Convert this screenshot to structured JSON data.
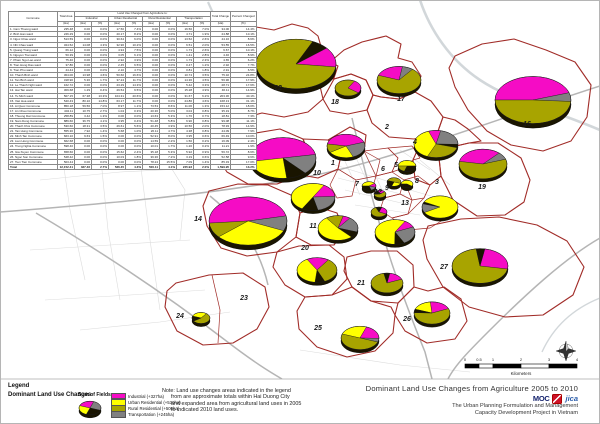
{
  "table": {
    "span_title": "Land Use Changed from Agriculture to:",
    "col_commune": "Commune",
    "col_total_area": "Total Area",
    "unit_ha": "(Ha)",
    "unit_pct": "(%)",
    "groups": [
      "Industrial",
      "Urban Residential",
      "Rural Residential",
      "Transportation"
    ],
    "col_total_change": "Total Change",
    "col_pct_change": "Percent Changed",
    "rows": [
      [
        "1. Cam Thuong ward",
        "235.48",
        "0.00",
        "0.0%",
        "17.50",
        "7.4%",
        "0.00",
        "0.0%",
        "16.50",
        "7.0%",
        "34.00",
        "14.4%"
      ],
      [
        "2. Binh Han ward",
        "246.29",
        "0.00",
        "0.0%",
        "20.17",
        "8.2%",
        "0.00",
        "0.0%",
        "4.71",
        "1.9%",
        "24.88",
        "10.1%"
      ],
      [
        "3. Ngoc Chau ward",
        "513.59",
        "0.00",
        "0.0%",
        "30.64",
        "6.0%",
        "0.00",
        "0.0%",
        "13.52",
        "2.6%",
        "44.16",
        "8.6%"
      ],
      [
        "4. Nhi Chau ward",
        "324.52",
        "14.08",
        "4.3%",
        "32.96",
        "10.2%",
        "0.00",
        "0.0%",
        "6.51",
        "2.0%",
        "53.55",
        "16.5%"
      ],
      [
        "5. Quang Trung ward",
        "66.12",
        "0.00",
        "0.0%",
        "4.94",
        "7.5%",
        "0.00",
        "0.0%",
        "1.73",
        "2.6%",
        "6.67",
        "10.1%"
      ],
      [
        "6. Nguyen Trai ward",
        "50.39",
        "0.00",
        "0.0%",
        "3.05",
        "6.1%",
        "0.00",
        "0.0%",
        "1.41",
        "2.8%",
        "4.46",
        "8.9%"
      ],
      [
        "7. Pham Ngu Lao ward",
        "75.40",
        "0.00",
        "0.0%",
        "2.92",
        "3.9%",
        "0.00",
        "0.0%",
        "1.73",
        "2.3%",
        "4.65",
        "6.2%"
      ],
      [
        "8. Tran Hung Dao ward",
        "37.86",
        "0.00",
        "0.0%",
        "2.45",
        "6.5%",
        "0.00",
        "0.0%",
        "0.47",
        "1.2%",
        "2.92",
        "7.7%"
      ],
      [
        "9. Tran Phu ward",
        "44.44",
        "0.00",
        "0.0%",
        "2.10",
        "4.7%",
        "0.00",
        "0.0%",
        "0.81",
        "1.8%",
        "2.91",
        "6.5%"
      ],
      [
        "10. Thanh Binh ward",
        "304.00",
        "13.98",
        "4.6%",
        "50.60",
        "16.6%",
        "0.00",
        "0.0%",
        "10.74",
        "3.5%",
        "75.32",
        "24.8%"
      ],
      [
        "11. Tan Binh ward",
        "318.90",
        "5.36",
        "1.7%",
        "37.24",
        "11.7%",
        "0.00",
        "0.0%",
        "14.36",
        "4.5%",
        "56.96",
        "17.9%"
      ],
      [
        "12. Le Thanh Nghi ward",
        "162.72",
        "0.00",
        "0.0%",
        "23.29",
        "14.3%",
        "0.00",
        "0.0%",
        "5.42",
        "3.3%",
        "28.71",
        "17.6%"
      ],
      [
        "13. Hai Tan ward",
        "309.68",
        "1.29",
        "0.4%",
        "29.54",
        "9.5%",
        "0.00",
        "0.0%",
        "15.28",
        "4.9%",
        "46.11",
        "14.9%"
      ],
      [
        "14. Tu Minh ward",
        "507.15",
        "67.38",
        "13.3%",
        "104.31",
        "20.6%",
        "0.00",
        "0.0%",
        "31.67",
        "6.2%",
        "203.36",
        "40.1%"
      ],
      [
        "15. Viet Hoa ward",
        "540.43",
        "80.10",
        "14.8%",
        "63.17",
        "11.7%",
        "0.00",
        "0.0%",
        "24.86",
        "4.6%",
        "168.13",
        "31.1%"
      ],
      [
        "16. Ai Quoc Commune",
        "850.18",
        "59.56",
        "7.0%",
        "8.97",
        "1.1%",
        "73.53",
        "8.6%",
        "11.06",
        "1.3%",
        "153.12",
        "18.0%"
      ],
      [
        "17. An Chau Commune",
        "404.11",
        "10.75",
        "2.7%",
        "1.04",
        "0.3%",
        "20.36",
        "5.0%",
        "3.04",
        "0.8%",
        "35.19",
        "8.7%"
      ],
      [
        "18. Thuong Dat Commune",
        "258.89",
        "3.42",
        "1.3%",
        "0.00",
        "0.0%",
        "13.63",
        "5.3%",
        "1.76",
        "0.7%",
        "18.81",
        "7.3%"
      ],
      [
        "19. Nam Dong Commune",
        "889.60",
        "36.75",
        "4.1%",
        "3.95",
        "0.4%",
        "51.48",
        "5.8%",
        "6.90",
        "0.8%",
        "99.08",
        "11.1%"
      ],
      [
        "20. Thach Khoi Commune",
        "530.60",
        "18.31",
        "3.5%",
        "29.61",
        "5.6%",
        "20.45",
        "3.9%",
        "10.56",
        "2.0%",
        "78.93",
        "14.9%"
      ],
      [
        "21. Tan Hung Commune",
        "555.30",
        "7.92",
        "1.4%",
        "5.68",
        "1.0%",
        "26.11",
        "4.7%",
        "4.38",
        "0.8%",
        "44.09",
        "7.9%"
      ],
      [
        "22. Minh Tan Commune",
        "663.10",
        "9.63",
        "1.5%",
        "0.00",
        "0.0%",
        "52.91",
        "8.0%",
        "3.95",
        "0.6%",
        "66.49",
        "10.0%"
      ],
      [
        "23. Lien Hong Commune",
        "662.68",
        "0.00",
        "0.0%",
        "0.00",
        "0.0%",
        "14.59",
        "2.2%",
        "1.50",
        "0.2%",
        "16.09",
        "2.4%"
      ],
      [
        "24. Trung Nghia Commune",
        "598.40",
        "0.00",
        "0.0%",
        "0.00",
        "0.0%",
        "10.01",
        "1.7%",
        "1.20",
        "0.2%",
        "11.21",
        "1.9%"
      ],
      [
        "25. Gia Xuyen Commune",
        "658.60",
        "0.00",
        "0.0%",
        "15.62",
        "2.4%",
        "35.18",
        "5.3%",
        "5.92",
        "0.9%",
        "56.72",
        "8.6%"
      ],
      [
        "26. Ngoc Son Commune",
        "548.42",
        "0.00",
        "0.0%",
        "10.03",
        "1.8%",
        "39.36",
        "7.2%",
        "3.19",
        "0.6%",
        "52.58",
        "9.6%"
      ],
      [
        "27. Tien Tien Commune",
        "503.44",
        "0.00",
        "0.0%",
        "0.00",
        "0.0%",
        "78.24",
        "15.5%",
        "7.09",
        "1.4%",
        "85.33",
        "17.0%"
      ]
    ],
    "total_row": [
      "Total",
      "12,152.41",
      "327.46",
      "2.7%",
      "526.45",
      "4.3%",
      "500.11",
      "4.1%",
      "245.93",
      "2.0%",
      "1,599.95",
      "13.2%"
    ]
  },
  "map": {
    "colors": {
      "industrial": "#F50CC5",
      "urban_residential": "#FFFF00",
      "rural_residential": "#A8A400",
      "transportation": "#808080",
      "pie_base": "#1A1500",
      "boundary": "#A12C28",
      "road_major": "#B5B5B5",
      "road_minor": "#DCDCDC"
    },
    "district_labels": [
      {
        "n": "1",
        "x": 333,
        "y": 165
      },
      {
        "n": "2",
        "x": 387,
        "y": 129
      },
      {
        "n": "3",
        "x": 437,
        "y": 184
      },
      {
        "n": "4",
        "x": 415,
        "y": 144
      },
      {
        "n": "5",
        "x": 396,
        "y": 167
      },
      {
        "n": "6",
        "x": 383,
        "y": 171
      },
      {
        "n": "7",
        "x": 357,
        "y": 186
      },
      {
        "n": "8",
        "x": 417,
        "y": 183
      },
      {
        "n": "9",
        "x": 387,
        "y": 190
      },
      {
        "n": "10",
        "x": 317,
        "y": 175
      },
      {
        "n": "11",
        "x": 313,
        "y": 228
      },
      {
        "n": "12",
        "x": 378,
        "y": 194
      },
      {
        "n": "13",
        "x": 405,
        "y": 205
      },
      {
        "n": "14",
        "x": 198,
        "y": 221
      },
      {
        "n": "15",
        "x": 244,
        "y": 155
      },
      {
        "n": "16",
        "x": 527,
        "y": 126
      },
      {
        "n": "17",
        "x": 401,
        "y": 101
      },
      {
        "n": "18",
        "x": 335,
        "y": 104
      },
      {
        "n": "19",
        "x": 482,
        "y": 189
      },
      {
        "n": "20",
        "x": 305,
        "y": 250
      },
      {
        "n": "21",
        "x": 361,
        "y": 285
      },
      {
        "n": "22",
        "x": 278,
        "y": 90
      },
      {
        "n": "23",
        "x": 244,
        "y": 300
      },
      {
        "n": "24",
        "x": 180,
        "y": 318
      },
      {
        "n": "25",
        "x": 318,
        "y": 330
      },
      {
        "n": "26",
        "x": 407,
        "y": 321
      },
      {
        "n": "27",
        "x": 444,
        "y": 269
      }
    ],
    "pies": [
      {
        "district": "22",
        "cx": 296,
        "cy": 64,
        "r": 40,
        "start": 320,
        "slices": [
          [
            "M",
            0.13
          ],
          [
            "O",
            0.8
          ],
          [
            "K",
            0.07
          ]
        ]
      },
      {
        "district": "18",
        "cx": 348,
        "cy": 88,
        "r": 13,
        "start": 300,
        "slices": [
          [
            "M",
            0.27
          ],
          [
            "O",
            0.73
          ]
        ]
      },
      {
        "district": "17",
        "cx": 399,
        "cy": 80,
        "r": 22,
        "start": 200,
        "slices": [
          [
            "M",
            0.22
          ],
          [
            "G",
            0.08
          ],
          [
            "O",
            0.7
          ]
        ]
      },
      {
        "district": "16",
        "cx": 533,
        "cy": 100,
        "r": 38,
        "start": 180,
        "slices": [
          [
            "M",
            0.45
          ],
          [
            "G",
            0.06
          ],
          [
            "O",
            0.49
          ]
        ]
      },
      {
        "district": "1",
        "cx": 346,
        "cy": 146,
        "r": 19,
        "start": 190,
        "slices": [
          [
            "M",
            0.42
          ],
          [
            "G",
            0.24
          ],
          [
            "Y",
            0.22
          ],
          [
            "O",
            0.12
          ]
        ]
      },
      {
        "district": "4",
        "cx": 436,
        "cy": 144,
        "r": 22,
        "start": 250,
        "slices": [
          [
            "M",
            0.09
          ],
          [
            "G",
            0.22
          ],
          [
            "K",
            0.04
          ],
          [
            "O",
            0.27
          ],
          [
            "Y",
            0.38
          ]
        ]
      },
      {
        "district": "15",
        "cx": 283,
        "cy": 158,
        "r": 33,
        "start": 170,
        "slices": [
          [
            "M",
            0.5
          ],
          [
            "G",
            0.16
          ],
          [
            "K",
            0.1
          ],
          [
            "Y",
            0.24
          ]
        ]
      },
      {
        "district": "5",
        "cx": 407,
        "cy": 166,
        "r": 9,
        "start": 180,
        "slices": [
          [
            "Y",
            0.5
          ],
          [
            "K",
            0.3
          ],
          [
            "O",
            0.2
          ]
        ]
      },
      {
        "district": "7",
        "cx": 369,
        "cy": 186,
        "r": 7,
        "start": 180,
        "slices": [
          [
            "Y",
            0.4
          ],
          [
            "M",
            0.15
          ],
          [
            "G",
            0.15
          ],
          [
            "K",
            0.3
          ]
        ]
      },
      {
        "district": "9",
        "cx": 394,
        "cy": 182,
        "r": 7,
        "start": 200,
        "slices": [
          [
            "O",
            0.5
          ],
          [
            "Y",
            0.25
          ],
          [
            "K",
            0.25
          ]
        ]
      },
      {
        "district": "8",
        "cx": 407,
        "cy": 184,
        "r": 6,
        "start": 180,
        "slices": [
          [
            "Y",
            0.6
          ],
          [
            "K",
            0.4
          ]
        ]
      },
      {
        "district": "12",
        "cx": 380,
        "cy": 194,
        "r": 6,
        "start": 250,
        "slices": [
          [
            "M",
            0.2
          ],
          [
            "O",
            0.6
          ],
          [
            "K",
            0.2
          ]
        ]
      },
      {
        "district": "12b",
        "cx": 379,
        "cy": 212,
        "r": 8,
        "start": 290,
        "slices": [
          [
            "M",
            0.26
          ],
          [
            "O",
            0.62
          ],
          [
            "K",
            0.12
          ]
        ]
      },
      {
        "district": "10",
        "cx": 313,
        "cy": 197,
        "r": 22,
        "start": 300,
        "slices": [
          [
            "M",
            0.16
          ],
          [
            "G",
            0.22
          ],
          [
            "K",
            0.12
          ],
          [
            "Y",
            0.5
          ]
        ]
      },
      {
        "district": "13",
        "cx": 440,
        "cy": 207,
        "r": 18,
        "start": 150,
        "slices": [
          [
            "G",
            0.13
          ],
          [
            "K",
            0.03
          ],
          [
            "Y",
            0.84
          ]
        ]
      },
      {
        "district": "19",
        "cx": 483,
        "cy": 164,
        "r": 24,
        "start": 190,
        "slices": [
          [
            "M",
            0.34
          ],
          [
            "G",
            0.08
          ],
          [
            "O",
            0.58
          ]
        ]
      },
      {
        "district": "14",
        "cx": 248,
        "cy": 221,
        "r": 39,
        "start": 175,
        "slices": [
          [
            "M",
            0.48
          ],
          [
            "G",
            0.1
          ],
          [
            "Y",
            0.32
          ],
          [
            "O",
            0.1
          ]
        ]
      },
      {
        "district": "11",
        "cx": 338,
        "cy": 228,
        "r": 20,
        "start": 285,
        "slices": [
          [
            "M",
            0.06
          ],
          [
            "G",
            0.2
          ],
          [
            "K",
            0.08
          ],
          [
            "Y",
            0.52
          ],
          [
            "O",
            0.14
          ]
        ]
      },
      {
        "district": "13b",
        "cx": 395,
        "cy": 232,
        "r": 20,
        "start": 300,
        "slices": [
          [
            "M",
            0.1
          ],
          [
            "G",
            0.24
          ],
          [
            "K",
            0.08
          ],
          [
            "Y",
            0.58
          ]
        ]
      },
      {
        "district": "20",
        "cx": 317,
        "cy": 270,
        "r": 20,
        "start": 240,
        "slices": [
          [
            "M",
            0.18
          ],
          [
            "O",
            0.34
          ],
          [
            "K",
            0.08
          ],
          [
            "Y",
            0.4
          ]
        ]
      },
      {
        "district": "21",
        "cx": 387,
        "cy": 283,
        "r": 16,
        "start": 280,
        "slices": [
          [
            "M",
            0.16
          ],
          [
            "O",
            0.78
          ],
          [
            "K",
            0.06
          ]
        ]
      },
      {
        "district": "27",
        "cx": 480,
        "cy": 266,
        "r": 28,
        "start": 280,
        "slices": [
          [
            "M",
            0.25
          ],
          [
            "O",
            0.7
          ],
          [
            "K",
            0.05
          ]
        ]
      },
      {
        "district": "26",
        "cx": 432,
        "cy": 313,
        "r": 18,
        "start": 200,
        "slices": [
          [
            "Y",
            0.18
          ],
          [
            "M",
            0.2
          ],
          [
            "O",
            0.57
          ],
          [
            "K",
            0.05
          ]
        ]
      },
      {
        "district": "25",
        "cx": 360,
        "cy": 338,
        "r": 19,
        "start": 200,
        "slices": [
          [
            "Y",
            0.25
          ],
          [
            "M",
            0.2
          ],
          [
            "G",
            0.05
          ],
          [
            "O",
            0.5
          ]
        ]
      },
      {
        "district": "24",
        "cx": 201,
        "cy": 318,
        "r": 9,
        "start": 200,
        "slices": [
          [
            "Y",
            0.3
          ],
          [
            "O",
            0.55
          ],
          [
            "K",
            0.15
          ]
        ]
      }
    ],
    "scalebar": {
      "labels": [
        "0",
        "0.5",
        "1",
        "2",
        "3",
        "4"
      ],
      "unit": "Kilometers"
    }
  },
  "legend": {
    "title": "Legend",
    "subtitle": "Dominant Land Use Changes",
    "fields_label": "Sum of Fields",
    "items": [
      {
        "key": "industrial",
        "label": "Industrial (+327ha)"
      },
      {
        "key": "urban_residential",
        "label": "Urban Residential (+530ha)"
      },
      {
        "key": "rural_residential",
        "label": "Rural Residential (+500ha)"
      },
      {
        "key": "transportation",
        "label": "Transportation (+245ha)"
      }
    ]
  },
  "note": {
    "lines": [
      "Note: Land use changes areas indicated in the legend",
      "from are approximate totals within Hai Duong City",
      "and expanded area from agricultural land uses in 2005",
      "to indicated 2010 land uses."
    ]
  },
  "titleblock": {
    "title": "Dominant Land Use Changes from Agriculture 2005 to 2010",
    "logo_moc": "MOC",
    "logo_jica": "jica",
    "org_line1": "The Urban Planning Formulation and Management",
    "org_line2": "Capacity Development Project in Vietnam"
  }
}
